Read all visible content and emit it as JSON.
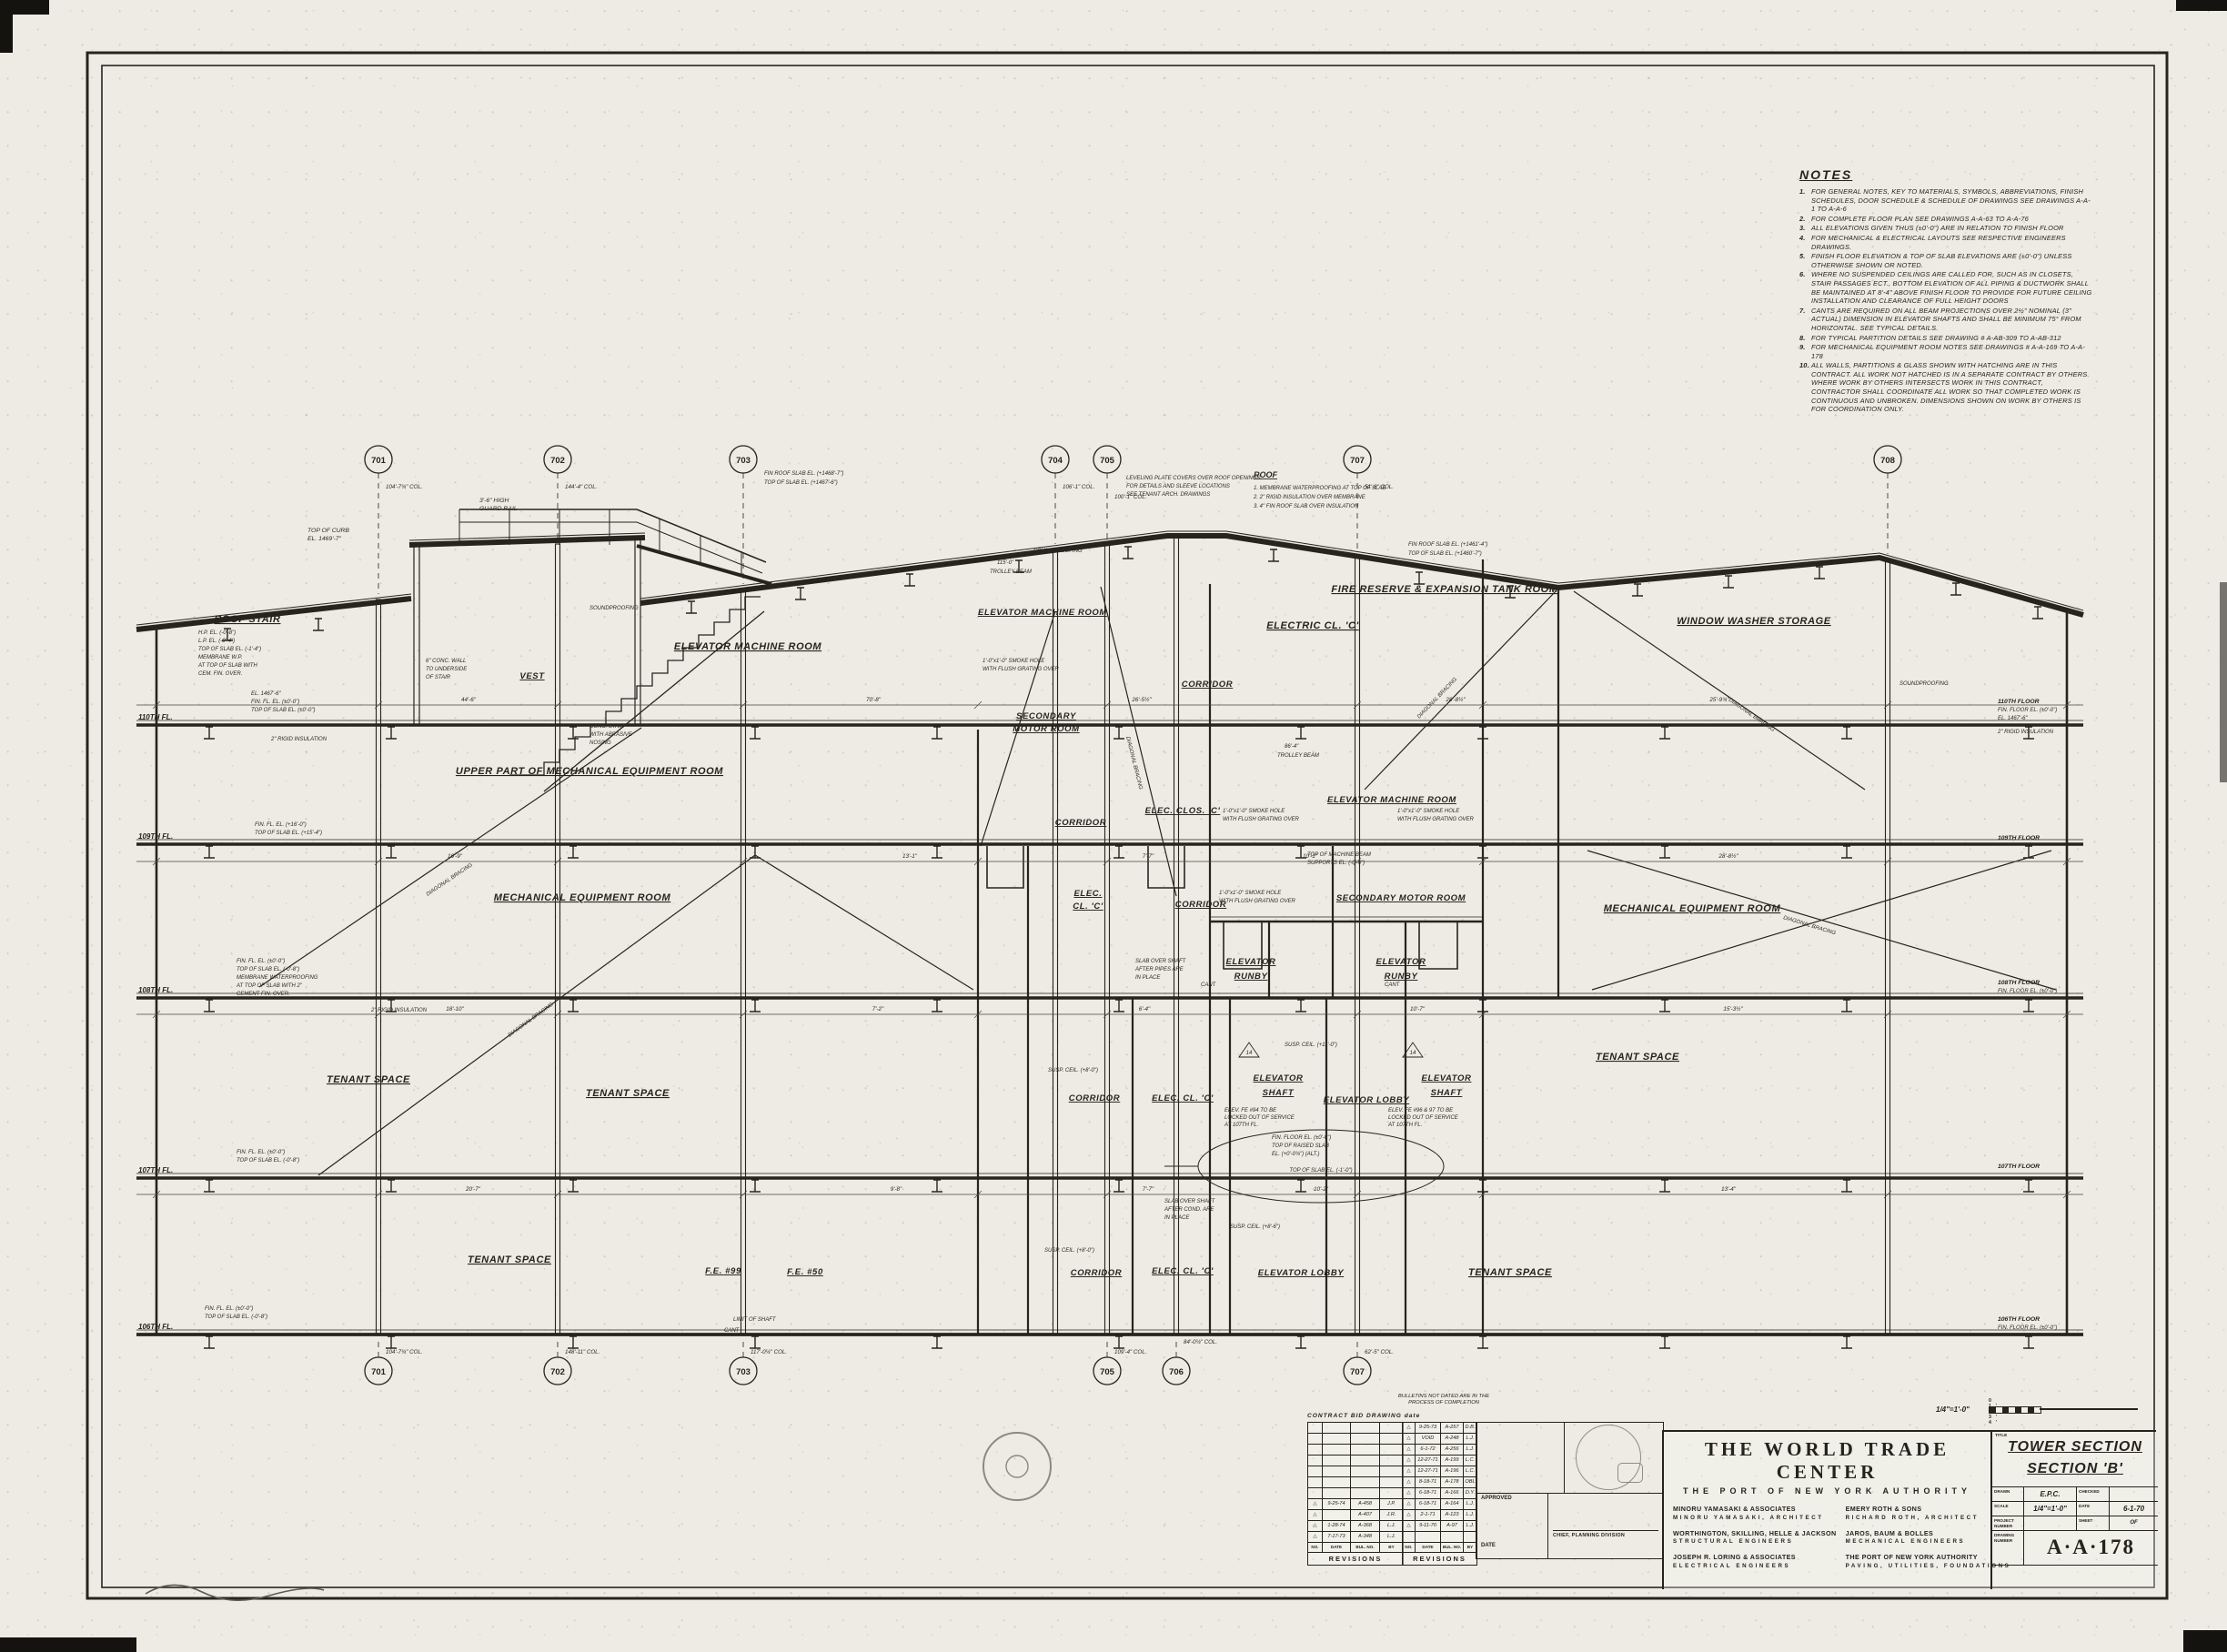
{
  "sheet": {
    "drawing_id": "A·A·178",
    "discipline": "ARCHITECTURAL SECTION"
  },
  "notes": {
    "title": "NOTES",
    "items": [
      {
        "n": "1.",
        "t": "FOR GENERAL NOTES, KEY TO MATERIALS, SYMBOLS, ABBREVIATIONS, FINISH SCHEDULES, DOOR SCHEDULE & SCHEDULE OF DRAWINGS SEE DRAWINGS A-A-1 TO A-A-6"
      },
      {
        "n": "2.",
        "t": "FOR COMPLETE FLOOR PLAN SEE DRAWINGS A-A-63 TO A-A-76"
      },
      {
        "n": "3.",
        "t": "ALL ELEVATIONS GIVEN THUS (±0'-0\") ARE IN RELATION TO FINISH FLOOR"
      },
      {
        "n": "4.",
        "t": "FOR MECHANICAL & ELECTRICAL LAYOUTS SEE RESPECTIVE ENGINEERS DRAWINGS."
      },
      {
        "n": "5.",
        "t": "FINISH FLOOR ELEVATION & TOP OF SLAB ELEVATIONS ARE (±0'-0\") UNLESS OTHERWISE SHOWN OR NOTED."
      },
      {
        "n": "6.",
        "t": "WHERE NO SUSPENDED CEILINGS ARE CALLED FOR, SUCH AS IN CLOSETS, STAIR PASSAGES ECT., BOTTOM ELEVATION OF ALL PIPING & DUCTWORK SHALL BE MAINTAINED AT 8'-4\" ABOVE FINISH FLOOR TO PROVIDE FOR FUTURE CEILING INSTALLATION AND CLEARANCE OF FULL HEIGHT DOORS"
      },
      {
        "n": "7.",
        "t": "CANTS ARE REQUIRED ON ALL BEAM PROJECTIONS OVER 2½\" NOMINAL (3\" ACTUAL) DIMENSION IN ELEVATOR SHAFTS AND SHALL BE MINIMUM 75° FROM HORIZONTAL. SEE TYPICAL DETAILS."
      },
      {
        "n": "8.",
        "t": "FOR TYPICAL PARTITION DETAILS SEE DRAWING # A-AB-309 TO A-AB-312"
      },
      {
        "n": "9.",
        "t": "FOR MECHANICAL EQUIPMENT ROOM NOTES SEE DRAWINGS # A-A-169 TO A-A-178"
      },
      {
        "n": "10.",
        "t": "ALL WALLS, PARTITIONS & GLASS SHOWN WITH HATCHING ARE IN THIS CONTRACT. ALL WORK NOT HATCHED IS IN A SEPARATE CONTRACT BY OTHERS. WHERE WORK BY OTHERS INTERSECTS WORK IN THIS CONTRACT, CONTRACTOR SHALL COORDINATE ALL WORK SO THAT COMPLETED WORK IS CONTINUOUS AND UNBROKEN. DIMENSIONS SHOWN ON WORK BY OTHERS IS FOR COORDINATION ONLY."
      }
    ]
  },
  "d": {
    "rooms": {
      "roof_stair": "ROOF STAIR",
      "emr": "ELEVATOR MACHINE ROOM",
      "vest": "VEST",
      "upper_mech": "UPPER PART OF MECHANICAL EQUIPMENT ROOM",
      "secondary": "SECONDARY",
      "motor_room": "MOTOR ROOM",
      "corridor": "CORRIDOR",
      "electric_cl": "ELECTRIC CL. 'C'",
      "fire_reserve": "FIRE RESERVE & EXPANSION TANK ROOM",
      "window_washer": "WINDOW WASHER STORAGE",
      "mech_room": "MECHANICAL EQUIPMENT ROOM",
      "elec_clos": "ELEC. CLOS. 'C'",
      "secondary_motor": "SECONDARY MOTOR ROOM",
      "elec_short": "ELEC.",
      "cl_c": "CL. 'C'",
      "elevator": "ELEVATOR",
      "runby": "RUNBY",
      "shaft": "SHAFT",
      "tenant": "TENANT SPACE",
      "elev_lobby": "ELEVATOR LOBBY",
      "elec_cl_c": "ELEC. CL. 'C'",
      "fe99": "F.E. #99",
      "fe50": "F.E. #50"
    },
    "floors_left": [
      "110TH FL.",
      "109TH FL.",
      "108TH FL.",
      "107TH FL.",
      "106TH FL."
    ],
    "floors_right": [
      "110TH FLOOR",
      "109TH FLOOR",
      "108TH FLOOR",
      "107TH FLOOR",
      "106TH FLOOR"
    ],
    "grid_top": [
      {
        "n": "701",
        "c": "104'-7¾\" COL."
      },
      {
        "n": "702",
        "c": "144'-4\" COL."
      },
      {
        "n": "703",
        "c": ""
      },
      {
        "n": "704",
        "c": "106'-1\" COL."
      },
      {
        "n": "705",
        "c": "100'-1\" COL."
      },
      {
        "n": "707",
        "c": "51'-8\" COL."
      },
      {
        "n": "708",
        "c": ""
      }
    ],
    "grid_bottom": [
      {
        "n": "701",
        "c": "104'-7¾\" COL."
      },
      {
        "n": "702",
        "c": "148'-11\" COL."
      },
      {
        "n": "703",
        "c": "117'-0¼\" COL."
      },
      {
        "n": "705",
        "c": "109'-4\" COL."
      },
      {
        "n": "706",
        "c": "84'-0¼\" COL."
      },
      {
        "n": "707",
        "c": "62'-5\" COL."
      }
    ],
    "dims": {
      "c1": [
        "44'-6\"",
        "70'-8\"",
        "26'-5½\"",
        "28'-8½\"",
        "25'-9¾\""
      ],
      "c2": [
        "16'-9\"",
        "13'-1\"",
        "7'-7\"",
        "10'-1\"",
        "28'-8½\""
      ],
      "c3": [
        "18'-10\"",
        "7'-2\"",
        "6'-4\"",
        "10'-7\"",
        "15'-3½\""
      ],
      "c4": [
        "20'-7\"",
        "9'-8\"",
        "7'-7\"",
        "10'-2\"",
        "13'-4\""
      ]
    },
    "ann": {
      "guard1": "3'-6\" HIGH",
      "guard2": "GUARD RAIL",
      "curb1": "TOP OF CURB",
      "curb2": "EL. 1469'-7\"",
      "frsl1": "FIN ROOF SLAB EL. (+1468'-7\")",
      "frsl2": "TOP OF SLAB EL. (+1467'-6\")",
      "rooft": "ROOF",
      "roofn1": "1. MEMBRANE WATERPROOFING AT TOP OF SLAB",
      "roofn2": "2. 2\" RIGID INSULATION OVER MEMBRANE",
      "roofn3": "3. 4\" FIN ROOF SLAB OVER INSULATION",
      "lev1": "LEVELING PLATE COVERS OVER ROOF OPENINGS",
      "lev2": "FOR DETAILS AND SLEEVE LOCATIONS",
      "lev3": "SEE TENANT ARCH. DRAWINGS",
      "frsr1": "FIN ROOF SLAB EL. (+1461'-4\")",
      "frsr2": "TOP OF SLAB EL. (+1460'-7\")",
      "sound": "SOUNDPROOFING",
      "trol1": "115'-0\"",
      "trolb": "TROLLEY BEAM",
      "trol2": "86'-4\"",
      "rigid": "2\" RIGID INSULATION",
      "el1467": "EL. 1467'-6\"",
      "ffe0": "FIN. FL. EL. (±0'-0\")",
      "tos0": "TOP OF SLAB EL. (±0'-0\")",
      "ffe16": "FIN. FL. EL. (+16'-0\")",
      "tos15": "TOP OF SLAB EL. (+15'-4\")",
      "tos8": "TOP OF SLAB EL. (-0'-8\")",
      "memb1": "MEMBRANE WATERPROOFING",
      "memb2": "AT TOP OF SLAB WITH 2\"",
      "memb3": "CEMENT FIN. OVER.",
      "rffe": "FIN. FLOOR EL. (±0'-0\")",
      "smk1": "1'-0\"x1'-0\" SMOKE HOLE",
      "smk2": "WITH FLUSH GRATING OVER",
      "mach1": "TOP OF MACHINE BEAM",
      "mach2": "SUPPORTS EL. (-0'-6\")",
      "sos1": "SLAB OVER SHAFT",
      "sos2": "AFTER PIPES ARE",
      "sos2b": "AFTER COND. ARE",
      "sos3": "IN PLACE",
      "cant": "CANT",
      "susp11": "SUSP. CEIL. (+11'-0\")",
      "susp8": "SUSP. CEIL. (+8'-0\")",
      "susp86": "SUSP. CEIL. (+8'-6\")",
      "lock1": "ELEV. FE #94 TO BE",
      "lock1b": "ELEV. FE #96 & 97 TO BE",
      "lock2": "LOCKED OUT OF SERVICE",
      "lock3": "AT 107TH FL.",
      "rsl2": "TOP OF RAISED SLAB",
      "rsl3": "EL. (+0'-0¾\") (ALT.)",
      "oval": "TOP OF SLAB EL. (-1'-0\")",
      "limit": "LIMIT OF SHAFT",
      "cw1": "6\" CONC. WALL",
      "cw2": "TO UNDERSIDE",
      "cw3": "OF STAIR",
      "cs1": "CONC. STAIR",
      "cs2": "WITH ABRASIVE",
      "cs3": "NOSING",
      "rs1": "H.P. EL. (-0'-8\")",
      "rs2": "L.P. EL. (-0'-4\")",
      "rs3": "TOP OF SLAB EL. (-1'-4\")",
      "rs4": "MEMBRANE W.P.",
      "rs5": "AT TOP OF SLAB WITH",
      "rs6": "CEM. FIN. OVER.",
      "diag": "DIAGONAL BRACING",
      "det14": "14"
    }
  },
  "revisions": {
    "bulletins_note1": "BULLETINS NOT DATED ARE IN THE",
    "bulletins_note2": "PROCESS OF COMPLETION",
    "contract_header": "CONTRACT  BID  DRAWING   date",
    "cols": [
      "NO.",
      "DATE",
      "BUL. NO.",
      "BY"
    ],
    "footer_label": "REVISIONS",
    "delta": "△",
    "left_rows": [
      {
        "d": "9-25-74",
        "b": "A-458",
        "y": "J.P."
      },
      {
        "d": "",
        "b": "A-407",
        "y": "J.R."
      },
      {
        "d": "1-28-74",
        "b": "A-368",
        "y": "L.J."
      },
      {
        "d": "7-17-73",
        "b": "A-348",
        "y": "L.J."
      }
    ],
    "right_rows": [
      {
        "d": "9-25-73",
        "b": "A-257",
        "y": "D.B."
      },
      {
        "d": "VOID",
        "b": "A-248",
        "y": "L.J."
      },
      {
        "d": "6-1-72",
        "b": "A-256",
        "y": "L.J."
      },
      {
        "d": "12-27-71",
        "b": "A-199",
        "y": "L.C."
      },
      {
        "d": "12-27-71",
        "b": "A-196",
        "y": "L.C."
      },
      {
        "d": "8-18-71",
        "b": "A-178",
        "y": "OBL"
      },
      {
        "d": "6-18-71",
        "b": "A-166",
        "y": "D.Y."
      },
      {
        "d": "6-18-71",
        "b": "A-164",
        "y": "L.J."
      },
      {
        "d": "2-1-71",
        "b": "A-123",
        "y": "L.J."
      },
      {
        "d": "9-11-70",
        "b": "A-97",
        "y": "L.J."
      }
    ]
  },
  "approvals": {
    "approved_label": "APPROVED",
    "chief": "CHIEF, PLANNING DIVISION",
    "date_label": "DATE"
  },
  "title_block": {
    "project": "THE WORLD TRADE CENTER",
    "client": "THE PORT OF NEW YORK AUTHORITY",
    "firms": [
      {
        "name": "MINORU YAMASAKI & ASSOCIATES",
        "role": "MINORU YAMASAKI, ARCHITECT"
      },
      {
        "name": "EMERY ROTH & SONS",
        "role": "RICHARD ROTH, ARCHITECT"
      },
      {
        "name": "WORTHINGTON, SKILLING, HELLE & JACKSON",
        "role": "STRUCTURAL ENGINEERS"
      },
      {
        "name": "JAROS, BAUM & BOLLES",
        "role": "MECHANICAL ENGINEERS"
      },
      {
        "name": "JOSEPH R. LORING & ASSOCIATES",
        "role": "ELECTRICAL ENGINEERS"
      },
      {
        "name": "THE PORT OF NEW YORK AUTHORITY",
        "role": "PAVING, UTILITIES, FOUNDATIONS"
      }
    ],
    "title_label": "TITLE",
    "sheet_title_1": "TOWER SECTION",
    "sheet_title_2": "SECTION 'B'",
    "fields": {
      "drawn_label": "DRAWN",
      "drawn": "E.P.C.",
      "checked_label": "CHECKED",
      "checked": "",
      "scale_label": "SCALE",
      "scale": "1/4\"=1'-0\"",
      "date_label": "DATE",
      "date": "6-1-70",
      "project_no_label": "PROJECT NUMBER",
      "project_no": "",
      "sheet_label": "SHEET",
      "of_label": "OF",
      "dwg_no_label": "DRAWING NUMBER",
      "dwg_no": "A·A·178"
    },
    "scale_bar": {
      "label": "1/4\"=1'-0\"",
      "ticks": "0 1' 2' 3' 4'"
    }
  }
}
